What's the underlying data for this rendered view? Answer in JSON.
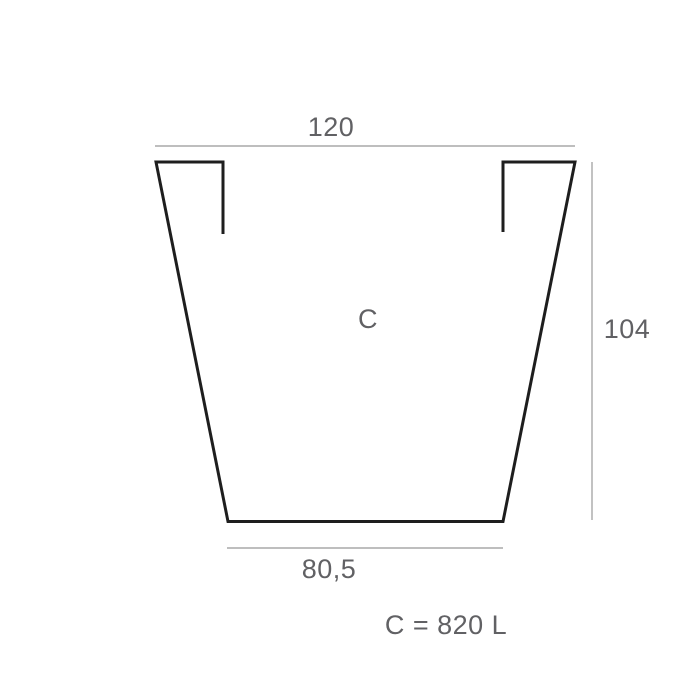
{
  "diagram": {
    "shape_label": "C",
    "dimensions": {
      "top_width": "120",
      "height": "104",
      "bottom_width": "80,5"
    },
    "capacity_note": "C = 820 L"
  },
  "colors": {
    "background": "#ffffff",
    "outline": "#1e1e1e",
    "dimension_line": "#a9a9a9",
    "label_text": "#616164"
  }
}
